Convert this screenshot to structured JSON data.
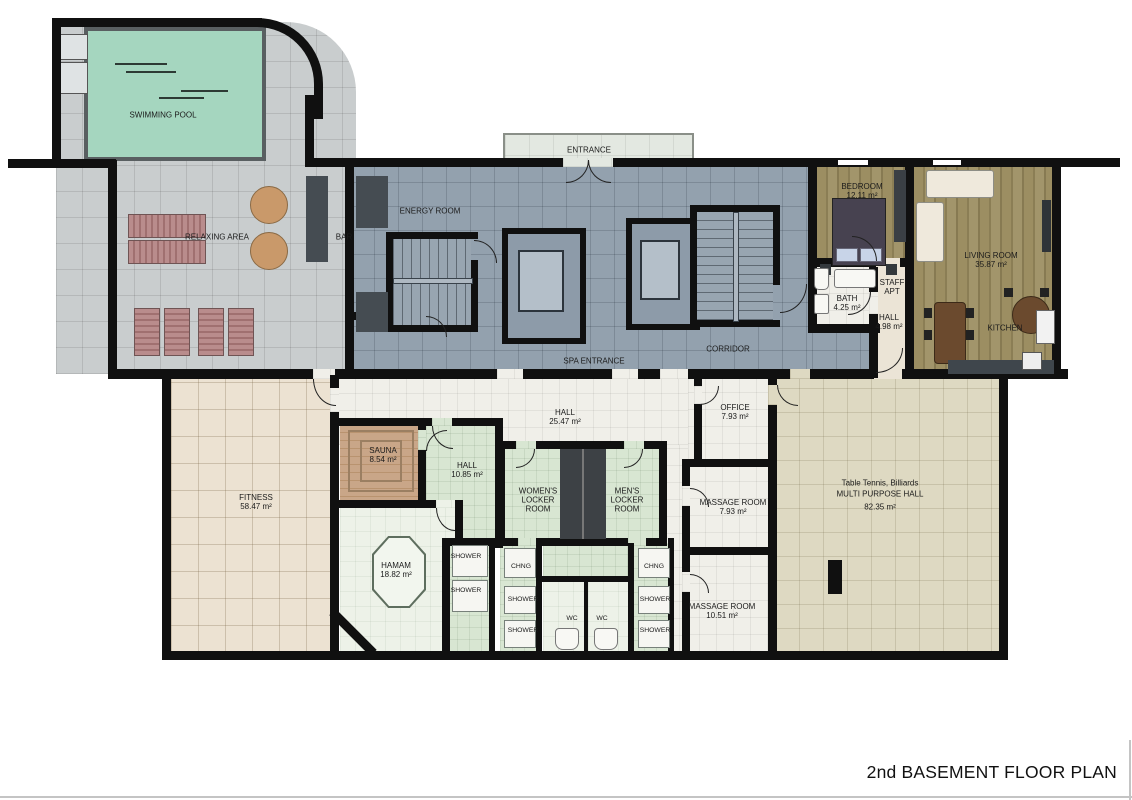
{
  "title": "2nd BASEMENT FLOOR PLAN",
  "colors": {
    "wall": "#101010",
    "pool_water": "#a5d6bf",
    "terrace_tile": "#c9cdce",
    "corridor_tile": "#93a1ae",
    "entrance_tile": "#e3e8e1",
    "wood_floor": "#978a5e",
    "fitness_tile": "#ece2d2",
    "white_tile": "#f0efe9",
    "green_tile": "#d8e6d2",
    "multi_hall_tile": "#ded9c2",
    "sauna_wood": "#c4a183",
    "dark_counter": "#454c52",
    "lounger": "#b98c8c",
    "table_wood": "#c9996a"
  },
  "rooms": {
    "swimming_pool": {
      "name": "SWIMMING POOL"
    },
    "relaxing_area": {
      "name": "RELAXING AREA"
    },
    "bar": {
      "name": "BAR"
    },
    "energy_room": {
      "name": "ENERGY ROOM"
    },
    "entrance": {
      "name": "ENTRANCE"
    },
    "spa_entrance": {
      "name": "SPA ENTRANCE"
    },
    "corridor": {
      "name": "CORRIDOR"
    },
    "bedroom": {
      "name": "BEDROOM",
      "area": "12.11 m²"
    },
    "staff_apt": {
      "line1": "STAFF",
      "line2": "APT"
    },
    "bath": {
      "name": "BATH",
      "area": "4.25 m²"
    },
    "staff_hall": {
      "name": "HALL",
      "area": "4.98 m²"
    },
    "living_room": {
      "name": "LIVING ROOM",
      "area": "35.87 m²"
    },
    "kitchen": {
      "name": "KITCHEN"
    },
    "fitness": {
      "name": "FITNESS",
      "area": "58.47 m²"
    },
    "spa_hall": {
      "name": "HALL",
      "area": "25.47 m²"
    },
    "sauna": {
      "name": "SAUNA",
      "area": "8.54 m²"
    },
    "small_hall": {
      "name": "HALL",
      "area": "10.85 m²"
    },
    "hamam": {
      "name": "HAMAM",
      "area": "18.82 m²"
    },
    "womens_locker": {
      "line1": "WOMEN'S",
      "line2": "LOCKER",
      "line3": "ROOM"
    },
    "mens_locker": {
      "line1": "MEN'S",
      "line2": "LOCKER",
      "line3": "ROOM"
    },
    "office": {
      "name": "OFFICE",
      "area": "7.93 m²"
    },
    "massage_room_1": {
      "name": "MASSAGE ROOM",
      "area": "7.93 m²"
    },
    "massage_room_2": {
      "name": "MASSAGE ROOM",
      "area": "10.51 m²"
    },
    "multi_purpose_hall": {
      "line1": "Table Tennis, Billiards",
      "line2": "MULTI PURPOSE HALL",
      "line3": "82.35 m²"
    }
  },
  "fixtures": {
    "shower": "SHOWER",
    "chng": "CHNG",
    "wc": "WC"
  }
}
